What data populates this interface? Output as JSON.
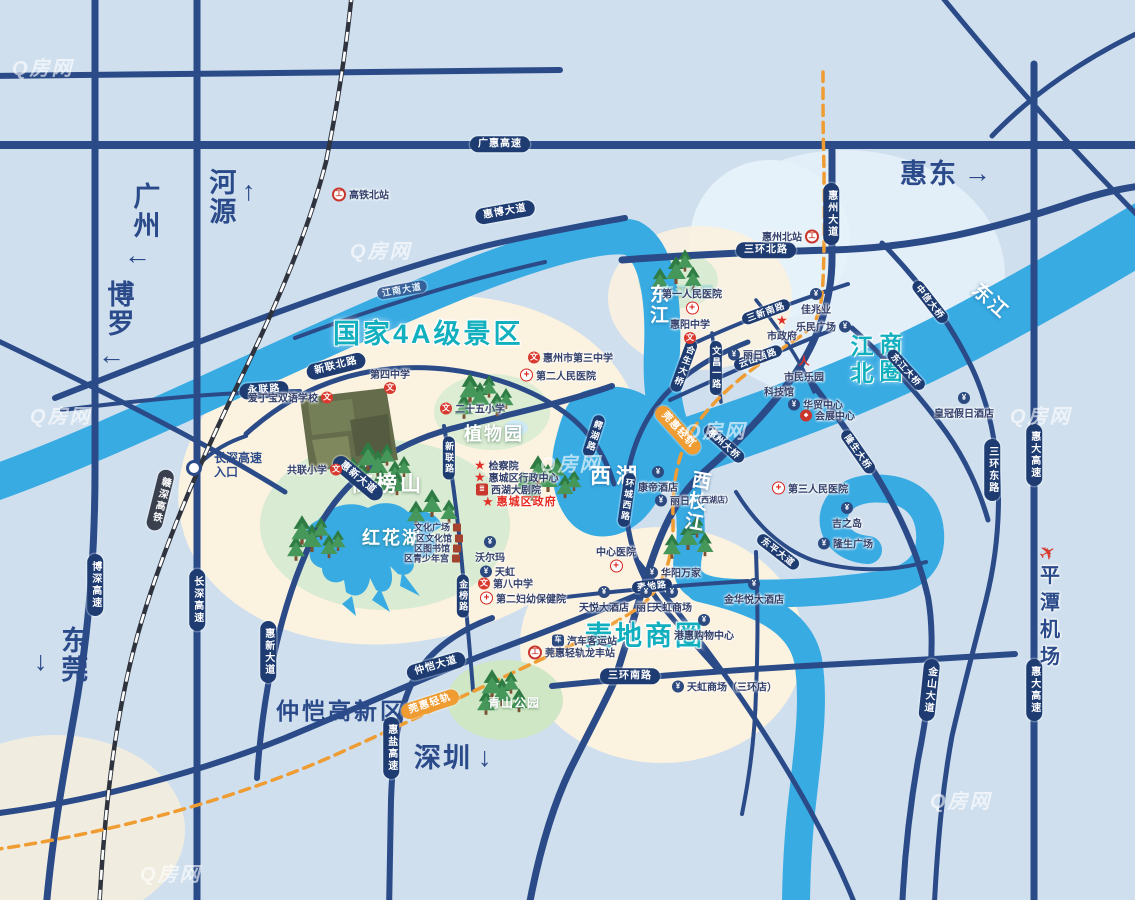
{
  "map": {
    "watermark_text": "Q房网",
    "colors": {
      "background": "#cfdfee",
      "river": "#38abe3",
      "road": "#2a4b88",
      "capsule": "#1e3c71",
      "teal_label": "#12b0bf",
      "navy_label": "#2b4a8a",
      "metro_orange": "#ef9c33",
      "beige_land": "#fbf2e0",
      "park_green": "#d9ebd2",
      "poi_red": "#d93a30"
    },
    "corner_labels": [
      {
        "text": "广州",
        "x": 130,
        "y": 182,
        "v": 1,
        "arrow": "←",
        "ax": 124,
        "ay": 242
      },
      {
        "text": "河源",
        "x": 206,
        "y": 168,
        "v": 1,
        "arrow": "↑",
        "ax": 242,
        "ay": 178
      },
      {
        "text": "博罗",
        "x": 104,
        "y": 280,
        "v": 1,
        "arrow": "←",
        "ax": 98,
        "ay": 342
      },
      {
        "text": "东莞",
        "x": 58,
        "y": 626,
        "v": 1,
        "arrow": "↓",
        "ax": 34,
        "ay": 648
      },
      {
        "text": "惠东",
        "x": 900,
        "y": 160,
        "arrow": "→",
        "ax": 964,
        "ay": 160
      },
      {
        "text": "深圳",
        "x": 414,
        "y": 744,
        "arrow": "↓",
        "ax": 478,
        "ay": 744
      }
    ],
    "area_labels": [
      {
        "text": "国家4A级景区",
        "x": 333,
        "y": 312,
        "cls": "teal-xl"
      },
      {
        "text": "麦地商圈",
        "x": 585,
        "y": 614,
        "cls": "teal-xl"
      },
      {
        "text": "江北",
        "x": 843,
        "y": 334,
        "cls": "teal-col"
      },
      {
        "text": "商圈",
        "x": 872,
        "y": 332,
        "cls": "teal-col"
      },
      {
        "text": "仲恺高新区",
        "x": 276,
        "y": 692,
        "cls": "navy-lg"
      },
      {
        "text": "西湖",
        "x": 590,
        "y": 460,
        "cls": "wl"
      },
      {
        "text": "东江",
        "x": 644,
        "y": 284,
        "cls": "wr",
        "v": 1
      },
      {
        "text": "东江",
        "x": 985,
        "y": 276,
        "cls": "wr",
        "rot": 42
      },
      {
        "text": "西枝江",
        "x": 688,
        "y": 468,
        "cls": "wr",
        "v": 1,
        "rot": 10
      },
      {
        "text": "高榜山",
        "x": 352,
        "y": 468,
        "cls": "wh"
      },
      {
        "text": "红花湖",
        "x": 362,
        "y": 524,
        "cls": "wh2"
      },
      {
        "text": "植物园",
        "x": 464,
        "y": 420,
        "cls": "wh2"
      },
      {
        "text": "青山公园",
        "x": 488,
        "y": 694,
        "cls": "wp"
      },
      {
        "text": "东江公园",
        "x": 662,
        "y": 282,
        "cls": "wp faint"
      }
    ],
    "road_labels": [
      {
        "t": "广惠高速",
        "x": 500,
        "y": 144
      },
      {
        "t": "惠博大道",
        "x": 505,
        "y": 212,
        "rot": -10
      },
      {
        "t": "江南大道",
        "x": 402,
        "y": 290,
        "rot": -10,
        "cls": "lt sm"
      },
      {
        "t": "三环北路",
        "x": 766,
        "y": 250
      },
      {
        "t": "新联北路",
        "x": 336,
        "y": 366,
        "rot": -14
      },
      {
        "t": "永联路",
        "x": 264,
        "y": 390,
        "rot": -4
      },
      {
        "t": "惠新大道",
        "x": 358,
        "y": 478,
        "rot": 40
      },
      {
        "t": "惠新大道",
        "x": 268,
        "y": 652,
        "v": 1
      },
      {
        "t": "三新南路",
        "x": 766,
        "y": 312,
        "rot": -20,
        "cls": "sm"
      },
      {
        "t": "云山西路",
        "x": 758,
        "y": 358,
        "rot": -20,
        "cls": "sm"
      },
      {
        "t": "文昌一路",
        "x": 716,
        "y": 368,
        "v": 1,
        "cls": "sm"
      },
      {
        "t": "惠州大道",
        "x": 831,
        "y": 214,
        "v": 1
      },
      {
        "t": "三环东路",
        "x": 992,
        "y": 470,
        "v": 1
      },
      {
        "t": "惠大高速",
        "x": 1034,
        "y": 455,
        "v": 1
      },
      {
        "t": "惠大高速",
        "x": 1034,
        "y": 690,
        "v": 1
      },
      {
        "t": "中信大桥",
        "x": 930,
        "y": 302,
        "rot": 52,
        "cls": "sm"
      },
      {
        "t": "合生大桥",
        "x": 684,
        "y": 366,
        "v": 1,
        "rot": 20,
        "cls": "sm"
      },
      {
        "t": "惠州大桥",
        "x": 724,
        "y": 444,
        "rot": 42,
        "cls": "sm"
      },
      {
        "t": "东江大桥",
        "x": 906,
        "y": 370,
        "rot": 48,
        "cls": "sm"
      },
      {
        "t": "隆生大桥",
        "x": 858,
        "y": 452,
        "rot": 55,
        "cls": "sm"
      },
      {
        "t": "鳄湖路",
        "x": 594,
        "y": 436,
        "v": 1,
        "rot": 18,
        "cls": "sm"
      },
      {
        "t": "环城西路",
        "x": 627,
        "y": 500,
        "v": 1,
        "rot": 8,
        "cls": "sm"
      },
      {
        "t": "麦地路",
        "x": 652,
        "y": 586,
        "rot": -6,
        "cls": "sm"
      },
      {
        "t": "三环南路",
        "x": 630,
        "y": 676
      },
      {
        "t": "仲恺大道",
        "x": 436,
        "y": 666,
        "rot": -16
      },
      {
        "t": "惠盐高速",
        "x": 391,
        "y": 748,
        "v": 1
      },
      {
        "t": "博深高速",
        "x": 95,
        "y": 585,
        "v": 1
      },
      {
        "t": "长深高速",
        "x": 197,
        "y": 600,
        "v": 1
      },
      {
        "t": "金榜路",
        "x": 463,
        "y": 596,
        "v": 1,
        "cls": "sm"
      },
      {
        "t": "新联路",
        "x": 449,
        "y": 458,
        "v": 1,
        "cls": "sm"
      },
      {
        "t": "金山大道",
        "x": 929,
        "y": 690,
        "v": 1,
        "rot": 6
      },
      {
        "t": "东平大道",
        "x": 778,
        "y": 552,
        "rot": 38,
        "cls": "sm"
      },
      {
        "t": "赣深高铁",
        "x": 160,
        "y": 500,
        "v": 1,
        "rot": 14,
        "cls": "dk"
      },
      {
        "t": "莞惠轻轨",
        "x": 678,
        "y": 430,
        "rot": 48,
        "cls": "og"
      },
      {
        "t": "莞惠轻轨",
        "x": 430,
        "y": 704,
        "rot": -18,
        "cls": "og"
      }
    ],
    "entrance": {
      "line1": "长深高速",
      "line2": "入口",
      "cx": 194,
      "cy": 468,
      "tx": 214,
      "ty": 452
    },
    "pois": [
      {
        "t": "爱丁宝双语学校",
        "x": 248,
        "y": 397,
        "ic": "school",
        "s": "r"
      },
      {
        "t": "第四中学",
        "x": 390,
        "y": 380,
        "ic": "school",
        "s": "b"
      },
      {
        "t": "二十五小学",
        "x": 440,
        "y": 408,
        "ic": "school",
        "s": "l"
      },
      {
        "t": "共联小学",
        "x": 287,
        "y": 469,
        "ic": "school",
        "s": "r"
      },
      {
        "t": "惠州市第三中学",
        "x": 528,
        "y": 357,
        "ic": "school",
        "s": "l"
      },
      {
        "t": "第八中学",
        "x": 478,
        "y": 583,
        "ic": "school",
        "s": "l"
      },
      {
        "t": "惠阳中学",
        "x": 690,
        "y": 330,
        "ic": "school",
        "s": "b"
      },
      {
        "t": "第一人民医院",
        "x": 692,
        "y": 300,
        "ic": "hosp",
        "s": "b"
      },
      {
        "t": "第二人民医院",
        "x": 520,
        "y": 375,
        "ic": "hosp",
        "s": "l"
      },
      {
        "t": "第三人民医院",
        "x": 772,
        "y": 488,
        "ic": "hosp",
        "s": "l"
      },
      {
        "t": "第二妇幼保健院",
        "x": 480,
        "y": 598,
        "ic": "hosp",
        "s": "l"
      },
      {
        "t": "中心医院",
        "x": 616,
        "y": 558,
        "ic": "hosp",
        "s": "b"
      },
      {
        "t": "市政府",
        "x": 782,
        "y": 328,
        "ic": "star",
        "s": "t"
      },
      {
        "t": "检察院",
        "x": 474,
        "y": 465,
        "ic": "star",
        "s": "l"
      },
      {
        "t": "惠城区行政中心",
        "x": 474,
        "y": 477,
        "ic": "star",
        "s": "l"
      },
      {
        "t": "西湖大剧院",
        "x": 476,
        "y": 489,
        "ic": "theater",
        "s": "l"
      },
      {
        "t": "惠城区政府",
        "x": 482,
        "y": 501,
        "ic": "star",
        "s": "l",
        "cls": "red"
      },
      {
        "t": "佳兆业",
        "x": 816,
        "y": 302,
        "ic": "shop",
        "s": "t"
      },
      {
        "t": "乐民广场",
        "x": 796,
        "y": 326,
        "ic": "shop",
        "s": "r"
      },
      {
        "t": "丽日",
        "x": 728,
        "y": 354,
        "ic": "shop",
        "s": "l"
      },
      {
        "t": "市民乐园",
        "x": 804,
        "y": 370,
        "ic": "sport",
        "s": "t"
      },
      {
        "t": "科技馆",
        "x": 764,
        "y": 391,
        "ic": "none",
        "s": "l"
      },
      {
        "t": "华贸中心",
        "x": 788,
        "y": 404,
        "ic": "shop",
        "s": "l"
      },
      {
        "t": "会展中心",
        "x": 800,
        "y": 415,
        "ic": "expo",
        "s": "l"
      },
      {
        "t": "皇冠假日酒店",
        "x": 964,
        "y": 406,
        "ic": "shop",
        "s": "t"
      },
      {
        "t": "吉之岛",
        "x": 847,
        "y": 516,
        "ic": "shop",
        "s": "t"
      },
      {
        "t": "隆生广场",
        "x": 818,
        "y": 543,
        "ic": "shop",
        "s": "l"
      },
      {
        "t": "康帝酒店",
        "x": 658,
        "y": 480,
        "ic": "shop",
        "s": "t"
      },
      {
        "t": "丽日",
        "sub": "（西湖店）",
        "x": 655,
        "y": 500,
        "ic": "shop",
        "s": "l"
      },
      {
        "t": "沃尔玛",
        "x": 490,
        "y": 550,
        "ic": "shop",
        "s": "t"
      },
      {
        "t": "天虹",
        "x": 480,
        "y": 571,
        "ic": "shop",
        "s": "l"
      },
      {
        "t": "华阳万家",
        "x": 646,
        "y": 572,
        "ic": "shop",
        "s": "l"
      },
      {
        "t": "天悦大酒店",
        "x": 604,
        "y": 600,
        "ic": "shop",
        "s": "t"
      },
      {
        "t": "丽日",
        "x": 646,
        "y": 600,
        "ic": "shop",
        "s": "t"
      },
      {
        "t": "天虹商场",
        "x": 672,
        "y": 600,
        "ic": "shop",
        "s": "t"
      },
      {
        "t": "港惠购物中心",
        "x": 704,
        "y": 628,
        "ic": "shop",
        "s": "t"
      },
      {
        "t": "金华悦大酒店",
        "x": 754,
        "y": 592,
        "ic": "shop",
        "s": "t"
      },
      {
        "t": "天虹商场（三环店）",
        "x": 672,
        "y": 686,
        "ic": "shop",
        "s": "l"
      },
      {
        "t": "汽车客运站",
        "x": 552,
        "y": 640,
        "ic": "bus",
        "s": "l"
      },
      {
        "t": "莞惠轻轨龙丰站",
        "x": 528,
        "y": 652,
        "ic": "rail",
        "s": "l"
      },
      {
        "t": "高铁北站",
        "x": 332,
        "y": 194,
        "ic": "rail",
        "s": "l"
      },
      {
        "t": "惠州北站",
        "x": 762,
        "y": 236,
        "ic": "rail",
        "s": "r"
      },
      {
        "t": "平潭机场",
        "x": 1048,
        "y": 608,
        "ic": "plane",
        "s": "t",
        "cls": "airport"
      },
      {
        "t": "文化广场",
        "x": 414,
        "y": 527,
        "ic": "bldg",
        "s": "r",
        "cls": "sm"
      },
      {
        "t": "区文化馆",
        "x": 416,
        "y": 538,
        "ic": "bldg",
        "s": "r",
        "cls": "sm"
      },
      {
        "t": "区图书馆",
        "x": 414,
        "y": 548,
        "ic": "bldg",
        "s": "r",
        "cls": "sm"
      },
      {
        "t": "区青少年宫",
        "x": 404,
        "y": 558,
        "ic": "bldg",
        "s": "r",
        "cls": "sm"
      }
    ],
    "tree_clusters": [
      {
        "x": 480,
        "y": 398,
        "n": 6
      },
      {
        "x": 676,
        "y": 272,
        "n": 4
      },
      {
        "x": 378,
        "y": 466,
        "n": 9
      },
      {
        "x": 312,
        "y": 540,
        "n": 6
      },
      {
        "x": 548,
        "y": 480,
        "n": 7
      },
      {
        "x": 688,
        "y": 538,
        "n": 4
      },
      {
        "x": 502,
        "y": 694,
        "n": 5
      },
      {
        "x": 432,
        "y": 505,
        "n": 3
      }
    ],
    "watermarks": [
      {
        "x": 30,
        "y": 400
      },
      {
        "x": 350,
        "y": 235
      },
      {
        "x": 685,
        "y": 415
      },
      {
        "x": 1010,
        "y": 400
      },
      {
        "x": 140,
        "y": 858
      },
      {
        "x": 930,
        "y": 785
      },
      {
        "x": 540,
        "y": 448
      },
      {
        "x": 12,
        "y": 52
      }
    ]
  }
}
